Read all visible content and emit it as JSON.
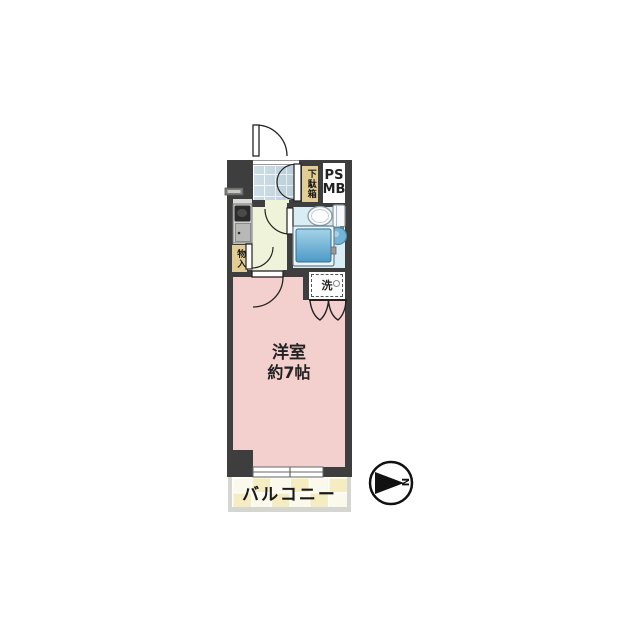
{
  "floor_plan": {
    "main_room": {
      "name": "洋室",
      "size": "約7帖"
    },
    "balcony": {
      "label": "バルコニー"
    },
    "entrance": {
      "shoe_cabinet_label": "下駄箱"
    },
    "utility": {
      "pipe_space_label": "PS",
      "meter_box_label": "MB",
      "storage_label": "物入",
      "washer_label": "洗"
    },
    "compass": {
      "north_label": "N",
      "direction": "right"
    },
    "colors": {
      "wall": "#3e3e3e",
      "main_room": "#f3d0cd",
      "hallway": "#eef3da",
      "bathroom": "#d9edf5",
      "entrance_tile": "#cfdfe8",
      "balcony_tile_a": "#f5ecc1",
      "balcony_tile_b": "#fbf8ec",
      "label_bg": "#e2cd94"
    }
  }
}
